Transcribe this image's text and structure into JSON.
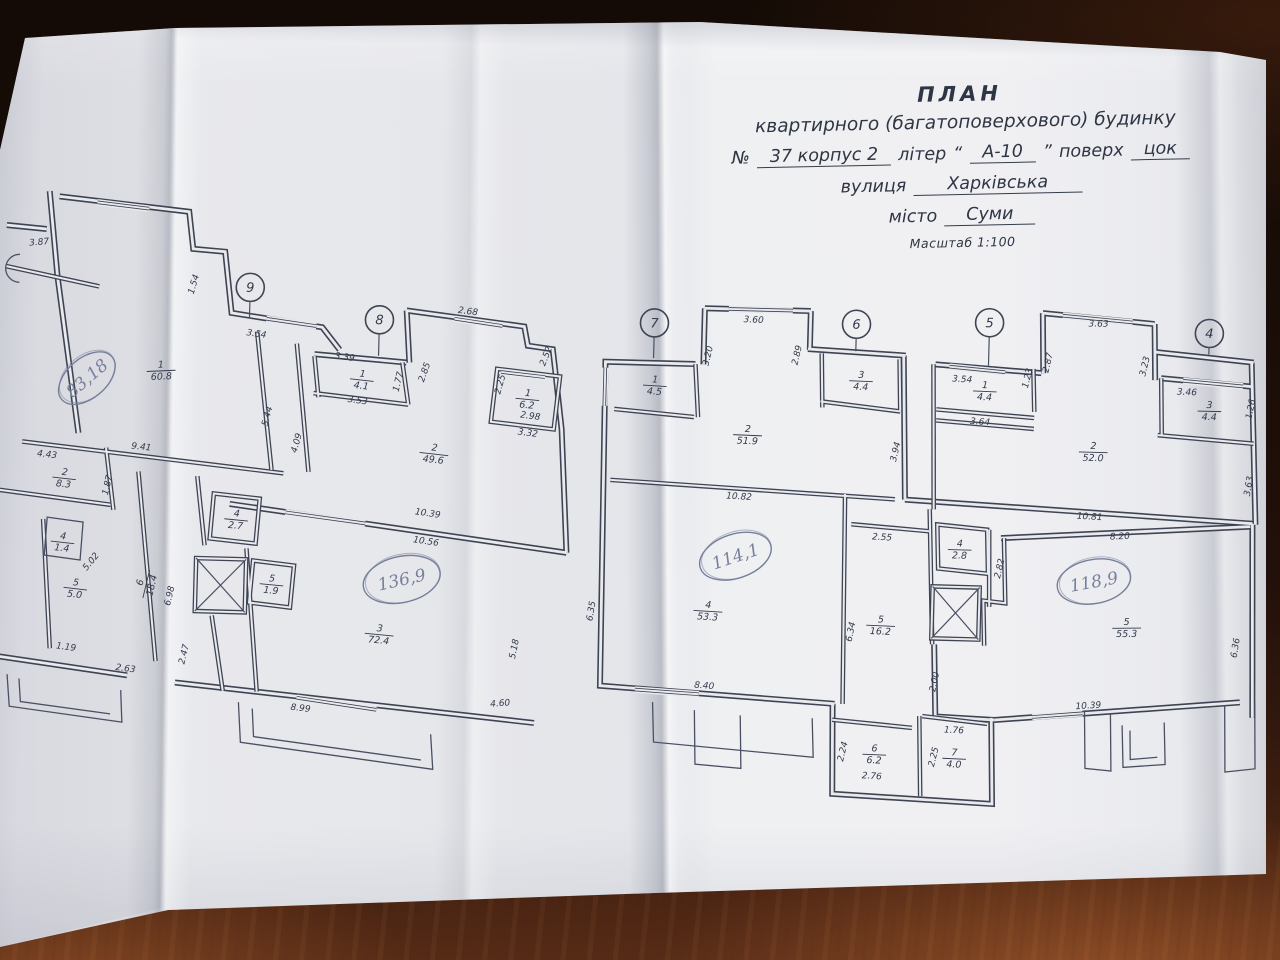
{
  "title_block": {
    "heading": "ПЛАН",
    "subheading": "квартирного (багатоповерхового) будинку",
    "number_label": "№",
    "number_value": "37 корпус 2",
    "liter_label": "літер",
    "liter_quote_open": "“",
    "liter_value": "А-10",
    "liter_quote_close": "”",
    "floor_label": "поверх",
    "floor_value": "цок",
    "street_label": "вулиця",
    "street_value": "Харківська",
    "city_label": "місто",
    "city_value": "Суми",
    "scale_note": "Масштаб 1:100"
  },
  "colors": {
    "ink": "#3e4453",
    "ink_thin": "#4a5063",
    "text_ink": "#333a4c",
    "paper_gap": "#e9eaee",
    "pencil": "#77809b"
  },
  "plan": {
    "axes": [
      {
        "n": "9",
        "x": 245,
        "y": 101,
        "ly": 132
      },
      {
        "n": "8",
        "x": 375,
        "y": 130,
        "ly": 166
      },
      {
        "n": "7",
        "x": 650,
        "y": 126,
        "ly": 161
      },
      {
        "n": "6",
        "x": 852,
        "y": 122,
        "ly": 149
      },
      {
        "n": "5",
        "x": 985,
        "y": 117,
        "ly": 160
      },
      {
        "n": "4",
        "x": 1205,
        "y": 122,
        "ly": 143
      }
    ],
    "rooms": [
      {
        "n": "1",
        "a": "60.8",
        "x": 158,
        "y": 186,
        "r": -4
      },
      {
        "n": "2",
        "a": "8.3",
        "x": 64,
        "y": 296,
        "r": 5
      },
      {
        "n": "4",
        "a": "1.4",
        "x": 64,
        "y": 360,
        "r": 5
      },
      {
        "n": "5",
        "a": "5.0",
        "x": 78,
        "y": 406,
        "r": 5
      },
      {
        "n": "6",
        "a": "18.4",
        "x": 148,
        "y": 400,
        "r": -78
      },
      {
        "n": "4",
        "a": "2.7",
        "x": 237,
        "y": 333,
        "r": 4
      },
      {
        "n": "5",
        "a": "1.9",
        "x": 274,
        "y": 397,
        "r": 4
      },
      {
        "n": "3",
        "a": "72.4",
        "x": 383,
        "y": 444,
        "r": 4
      },
      {
        "n": "1",
        "a": "4.1",
        "x": 359,
        "y": 190,
        "r": 5
      },
      {
        "n": "2",
        "a": "49.6",
        "x": 433,
        "y": 262,
        "r": 5
      },
      {
        "n": "1",
        "a": "6.2",
        "x": 525,
        "y": 205,
        "r": 4
      },
      {
        "n": "1",
        "a": "4.5",
        "x": 652,
        "y": 188,
        "r": 2
      },
      {
        "n": "2",
        "a": "51.9",
        "x": 746,
        "y": 235,
        "r": 1
      },
      {
        "n": "3",
        "a": "4.4",
        "x": 858,
        "y": 178,
        "r": 1
      },
      {
        "n": "4",
        "a": "53.3",
        "x": 711,
        "y": 412,
        "r": 2
      },
      {
        "n": "5",
        "a": "16.2",
        "x": 884,
        "y": 422,
        "r": 1
      },
      {
        "n": "6",
        "a": "6.2",
        "x": 881,
        "y": 551,
        "r": 1
      },
      {
        "n": "7",
        "a": "4.0",
        "x": 961,
        "y": 553,
        "r": 1
      },
      {
        "n": "1",
        "a": "4.4",
        "x": 982,
        "y": 185,
        "r": 1
      },
      {
        "n": "2",
        "a": "52.0",
        "x": 1092,
        "y": 243,
        "r": 0
      },
      {
        "n": "3",
        "a": "4.4",
        "x": 1207,
        "y": 199,
        "r": 0
      },
      {
        "n": "4",
        "a": "2.8",
        "x": 961,
        "y": 344,
        "r": 0
      },
      {
        "n": "5",
        "a": "55.3",
        "x": 1130,
        "y": 418,
        "r": -2
      }
    ],
    "handwritten": [
      {
        "t": "83,18",
        "x": 84,
        "y": 196,
        "r": -42,
        "rx": 33,
        "ry": 20
      },
      {
        "t": "136,9",
        "x": 404,
        "y": 389,
        "r": -14,
        "rx": 39,
        "ry": 23
      },
      {
        "t": "114,1",
        "x": 737,
        "y": 357,
        "r": -20,
        "rx": 37,
        "ry": 22
      },
      {
        "t": "118,9",
        "x": 1096,
        "y": 373,
        "r": -12,
        "rx": 37,
        "ry": 22
      }
    ],
    "dims": [
      {
        "t": "3.87",
        "x": 33,
        "y": 64,
        "r": -6
      },
      {
        "t": "1.54",
        "x": 191,
        "y": 100,
        "r": -75
      },
      {
        "t": "3.54",
        "x": 252,
        "y": 150,
        "r": 7
      },
      {
        "t": "9.41",
        "x": 140,
        "y": 266,
        "r": 5
      },
      {
        "t": "4.43",
        "x": 46,
        "y": 276,
        "r": 5
      },
      {
        "t": "1.87",
        "x": 110,
        "y": 303,
        "r": -78
      },
      {
        "t": "5.02",
        "x": 95,
        "y": 381,
        "r": -52
      },
      {
        "t": "1.19",
        "x": 70,
        "y": 468,
        "r": 6
      },
      {
        "t": "2.63",
        "x": 130,
        "y": 488,
        "r": 6
      },
      {
        "t": "2.47",
        "x": 191,
        "y": 470,
        "r": -78
      },
      {
        "t": "6.98",
        "x": 175,
        "y": 412,
        "r": -78
      },
      {
        "t": "5.44",
        "x": 268,
        "y": 230,
        "r": -76
      },
      {
        "t": "4.09",
        "x": 298,
        "y": 256,
        "r": -76
      },
      {
        "t": "3.39",
        "x": 341,
        "y": 171,
        "r": 6
      },
      {
        "t": "3.53",
        "x": 355,
        "y": 214,
        "r": 6
      },
      {
        "t": "1.77",
        "x": 398,
        "y": 192,
        "r": -78
      },
      {
        "t": "2.85",
        "x": 424,
        "y": 182,
        "r": -72
      },
      {
        "t": "2.68",
        "x": 463,
        "y": 122,
        "r": 6
      },
      {
        "t": "2.52",
        "x": 545,
        "y": 163,
        "r": -70
      },
      {
        "t": "2.25",
        "x": 500,
        "y": 192,
        "r": -76
      },
      {
        "t": "2.98",
        "x": 528,
        "y": 225,
        "r": 6
      },
      {
        "t": "3.32",
        "x": 526,
        "y": 242,
        "r": 6
      },
      {
        "t": "10.39",
        "x": 428,
        "y": 325,
        "r": 7
      },
      {
        "t": "10.56",
        "x": 427,
        "y": 353,
        "r": 7
      },
      {
        "t": "5.18",
        "x": 521,
        "y": 456,
        "r": -80
      },
      {
        "t": "4.60",
        "x": 506,
        "y": 513,
        "r": -6
      },
      {
        "t": "8.99",
        "x": 306,
        "y": 523,
        "r": 5
      },
      {
        "t": "3.60",
        "x": 749,
        "y": 123,
        "r": 1
      },
      {
        "t": "3.20",
        "x": 707,
        "y": 158,
        "r": -78
      },
      {
        "t": "2.89",
        "x": 796,
        "y": 155,
        "r": -78
      },
      {
        "t": "3.94",
        "x": 897,
        "y": 249,
        "r": -78
      },
      {
        "t": "10.82",
        "x": 739,
        "y": 300,
        "r": 2
      },
      {
        "t": "6.35",
        "x": 597,
        "y": 416,
        "r": -82
      },
      {
        "t": "8.40",
        "x": 709,
        "y": 490,
        "r": 3
      },
      {
        "t": "2.55",
        "x": 883,
        "y": 337,
        "r": 2
      },
      {
        "t": "6.34",
        "x": 857,
        "y": 430,
        "r": -80
      },
      {
        "t": "2.82",
        "x": 1004,
        "y": 363,
        "r": -78
      },
      {
        "t": "2.00",
        "x": 942,
        "y": 478,
        "r": -80
      },
      {
        "t": "2.24",
        "x": 852,
        "y": 550,
        "r": -78
      },
      {
        "t": "2.76",
        "x": 879,
        "y": 576,
        "r": 2
      },
      {
        "t": "1.76",
        "x": 960,
        "y": 528,
        "r": 1
      },
      {
        "t": "2.25",
        "x": 943,
        "y": 553,
        "r": -78
      },
      {
        "t": "3.54",
        "x": 959,
        "y": 177,
        "r": 2
      },
      {
        "t": "3.64",
        "x": 978,
        "y": 219,
        "r": 2
      },
      {
        "t": "1.23",
        "x": 1027,
        "y": 172,
        "r": -78
      },
      {
        "t": "2.87",
        "x": 1047,
        "y": 156,
        "r": -78
      },
      {
        "t": "3.63",
        "x": 1094,
        "y": 118,
        "r": -1
      },
      {
        "t": "3.23",
        "x": 1144,
        "y": 157,
        "r": -78
      },
      {
        "t": "3.46",
        "x": 1184,
        "y": 184,
        "r": 1
      },
      {
        "t": "1.26",
        "x": 1251,
        "y": 197,
        "r": -80
      },
      {
        "t": "3.63",
        "x": 1251,
        "y": 274,
        "r": -82
      },
      {
        "t": "10.81",
        "x": 1090,
        "y": 311,
        "r": 2
      },
      {
        "t": "8.20",
        "x": 1121,
        "y": 330,
        "r": -4
      },
      {
        "t": "6.36",
        "x": 1242,
        "y": 436,
        "r": -82
      },
      {
        "t": "10.39",
        "x": 1094,
        "y": 500,
        "r": -5
      }
    ],
    "walls_outer": [
      "M 42,10 L 52,95 L 77,251",
      "M 52,15 L 182,27 L 187,64 L 219,66 L 227,127 L 318,139 L 336,161",
      "M 311,166 L 403,172",
      "M 402,120 L 406,172",
      "M 402,120 L 520,133 L 524,152 L 549,155 L 552,176",
      "M 552,176 L 560,235 L 568,358",
      "M 230,318 L 568,358",
      "M 180,498 L 540,529",
      "M 0,476 L 132,492",
      "M 0,45 L 40,48",
      "M 692,166 L 602,166 L 605,490 L 840,502",
      "M 700,110 L 700,166",
      "M 700,110 L 806,110",
      "M 806,110 L 806,149",
      "M 804,148 L 902,152",
      "M 900,152 L 905,296",
      "M 932,160 L 1038,166",
      "M 1038,106 L 1040,166",
      "M 1038,106 L 1150,114",
      "M 1150,114 L 1152,170",
      "M 1152,142 L 1250,150",
      "M 1158,168 L 1248,174",
      "M 1248,150 L 1256,312",
      "M 905,296 L 1253,311",
      "M 1002,332 L 1251,314",
      "M 1253,311 L 1258,505",
      "M 1000,514 L 1245,490",
      "M 938,440 L 941,512 L 1000,514",
      "M 838,502 L 840,592 L 1000,598 L 997,512"
    ],
    "walls_inner": [
      "M 0,86 L 94,104",
      "M 21,261 L 283,286",
      "M 253,145 L 271,283",
      "M 293,156 L 308,284",
      "M 0,310 L 111,322",
      "M 105,265 L 114,327",
      "M 138,288 L 160,477",
      "M 197,291 L 206,360",
      "M 215,430 L 228,505",
      "M 44,338 L 54,467",
      "M 311,168 L 316,209",
      "M 399,172 L 406,214",
      "M 311,205 L 406,214",
      "M 494,176 L 557,182 L 552,235 L 489,229 Z",
      "M 248,362 L 262,505",
      "M 214,308 L 260,312 L 257,357 L 211,353 Z",
      "M 255,374 L 296,378 L 293,420 L 252,416 Z",
      "M 612,213 L 692,219",
      "M 692,166 L 696,219",
      "M 610,284 L 895,296",
      "M 845,292 L 848,502",
      "M 852,322 L 930,327",
      "M 818,152 L 820,206",
      "M 896,156 L 898,208",
      "M 818,200 L 898,208",
      "M 938,320 L 988,324 L 990,368 L 940,364 Z",
      "M 990,324 L 992,401",
      "M 930,160 L 934,305",
      "M 930,305 L 936,440",
      "M 1005,332 L 1008,397 L 986,395 L 988,440",
      "M 838,518 L 918,524",
      "M 925,512 L 928,592",
      "M 928,512 L 993,518",
      "M 934,205 L 1032,211",
      "M 934,216 L 1032,222",
      "M 1030,162 L 1032,205",
      "M 1156,225 L 1252,231",
      "M 1158,168 L 1160,225"
    ],
    "walls_thin": [
      "M 12,494 L 15,526 L 128,539 L 126,507",
      "M 24,498 L 26,521 L 116,531",
      "M 244,516 L 247,556 L 440,578 L 437,543",
      "M 258,522 L 260,550 L 428,569",
      "M 658,505 L 660,545 L 820,556 L 818,517",
      "M 700,512 L 702,566 L 748,569 L 746,516",
      "M 1090,502 L 1092,560 L 1118,562 L 1116,504",
      "M 1128,516 L 1130,558 L 1172,554 L 1170,512",
      "M 1136,521 L 1137,550 L 1164,547",
      "M 1230,493 L 1232,560 L 1262,556 L 1260,490",
      "M 14,74 A 13,13 0 1 0 14,102",
      "M 48,336 L 84,340 L 82,378 L 46,374 Z"
    ],
    "windows": [
      "M 90,20 L 142,25",
      "M 262,132 L 312,138",
      "M 450,127 L 498,133",
      "M 724,110 L 788,110",
      "M 602,172 L 602,210",
      "M 1058,108 L 1128,113",
      "M 1180,170 L 1240,174",
      "M 286,325 L 366,334",
      "M 1038,510 L 1088,505",
      "M 302,510 L 382,520",
      "M 640,493 L 704,496",
      "M 946,162 L 1002,166",
      "M 498,179 L 542,183"
    ],
    "elevators": [
      {
        "x": 198,
        "y": 373,
        "w": 50,
        "h": 53
      },
      {
        "x": 935,
        "y": 382,
        "w": 47,
        "h": 52
      }
    ]
  }
}
